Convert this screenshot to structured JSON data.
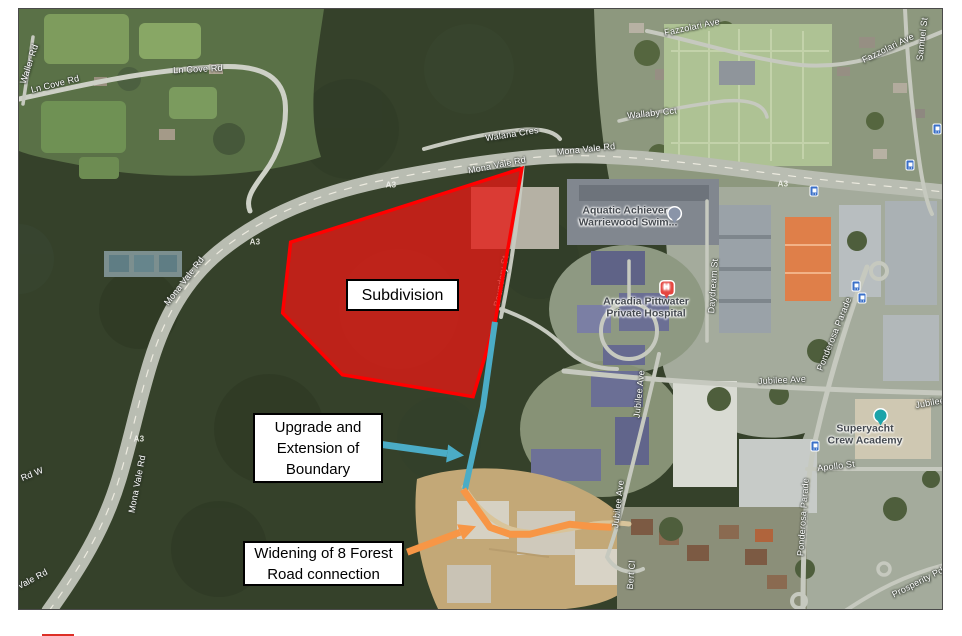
{
  "map": {
    "description": "Satellite map of Warriewood / Mona Vale Rd area with subdivision annotation overlay"
  },
  "annotations": {
    "subdivision_fill": "rgba(228,26,21,0.78)",
    "subdivision_stroke": "#ff0000",
    "boundary_color": "#4bacc6",
    "road_color": "#f79646"
  },
  "callouts": {
    "subdivision": {
      "label": "Subdivision"
    },
    "upgrade": {
      "line1": "Upgrade and",
      "line2": "Extension of",
      "line3": "Boundary"
    },
    "widening": {
      "line1": "Widening of 8 Forest",
      "line2": "Road connection"
    }
  },
  "road_labels": [
    {
      "text": "Waller Rd",
      "x": 10,
      "y": 55,
      "rot": -72
    },
    {
      "text": "Ln Cove Rd",
      "x": 36,
      "y": 75,
      "rot": -14
    },
    {
      "text": "Ln Cove Rd",
      "x": 179,
      "y": 60,
      "rot": -3
    },
    {
      "text": "Walana Cres",
      "x": 493,
      "y": 125,
      "rot": -9
    },
    {
      "text": "Mona Vale Rd",
      "x": 478,
      "y": 156,
      "rot": -11
    },
    {
      "text": "Mona Vale Rd",
      "x": 567,
      "y": 140,
      "rot": -6
    },
    {
      "text": "Wallaby Cct",
      "x": 633,
      "y": 104,
      "rot": -6
    },
    {
      "text": "Fazzolari Ave",
      "x": 673,
      "y": 18,
      "rot": -12
    },
    {
      "text": "Fazzolari Ave",
      "x": 869,
      "y": 39,
      "rot": -26
    },
    {
      "text": "Samuel St",
      "x": 903,
      "y": 30,
      "rot": -83
    },
    {
      "text": "Mona Vale Rd",
      "x": 165,
      "y": 272,
      "rot": -52
    },
    {
      "text": "Mona Vale Rd",
      "x": 118,
      "y": 475,
      "rot": -79
    },
    {
      "text": "Rd W",
      "x": 13,
      "y": 465,
      "rot": -22
    },
    {
      "text": "Mona Vale Rd",
      "x": 2,
      "y": 576,
      "rot": -28
    },
    {
      "text": "Boundary St",
      "x": 482,
      "y": 272,
      "rot": -80
    },
    {
      "text": "Daydream St",
      "x": 694,
      "y": 277,
      "rot": -86
    },
    {
      "text": "Jubilee Ave",
      "x": 763,
      "y": 371,
      "rot": -3
    },
    {
      "text": "Jubilee Ave",
      "x": 620,
      "y": 385,
      "rot": -84
    },
    {
      "text": "Jubilee Ave",
      "x": 599,
      "y": 495,
      "rot": -83
    },
    {
      "text": "Jubilee Ave",
      "x": 920,
      "y": 392,
      "rot": -10
    },
    {
      "text": "Ponderosa Parade",
      "x": 815,
      "y": 325,
      "rot": -68
    },
    {
      "text": "Ponderosa Parade",
      "x": 784,
      "y": 508,
      "rot": -86
    },
    {
      "text": "Apollo St",
      "x": 817,
      "y": 457,
      "rot": -7
    },
    {
      "text": "Bert Cl",
      "x": 612,
      "y": 566,
      "rot": -85
    },
    {
      "text": "Prosperity Pde",
      "x": 901,
      "y": 572,
      "rot": -27
    }
  ],
  "route_shields": [
    {
      "text": "A3",
      "x": 372,
      "y": 176
    },
    {
      "text": "A3",
      "x": 236,
      "y": 233
    },
    {
      "text": "A3",
      "x": 120,
      "y": 430
    },
    {
      "text": "A3",
      "x": 764,
      "y": 175
    }
  ],
  "poi_labels": [
    {
      "name": "aquatic-achievers-swim-school",
      "line1": "Aquatic Achievers",
      "line2": "Warriewood Swim...",
      "x": 609,
      "y": 208,
      "marker": "gray",
      "dx": 47,
      "dy": 14,
      "glyph": ""
    },
    {
      "name": "arcadia-pittwater-private-hospital",
      "line1": "Arcadia Pittwater",
      "line2": "Private Hospital",
      "x": 627,
      "y": 299,
      "marker": "hospital",
      "dx": 21,
      "dy": -2,
      "glyph": "H"
    },
    {
      "name": "superyacht-crew-academy",
      "line1": "Superyacht",
      "line2": "Crew Academy",
      "x": 846,
      "y": 426,
      "marker": "teal",
      "dx": 16,
      "dy": -2,
      "glyph": ""
    }
  ],
  "transit_stops": [
    {
      "x": 795,
      "y": 182
    },
    {
      "x": 891,
      "y": 156
    },
    {
      "x": 837,
      "y": 277
    },
    {
      "x": 843,
      "y": 289
    },
    {
      "x": 796,
      "y": 437
    },
    {
      "x": 918,
      "y": 120
    }
  ],
  "legend": {
    "swatch_color": "#dd2f26"
  }
}
